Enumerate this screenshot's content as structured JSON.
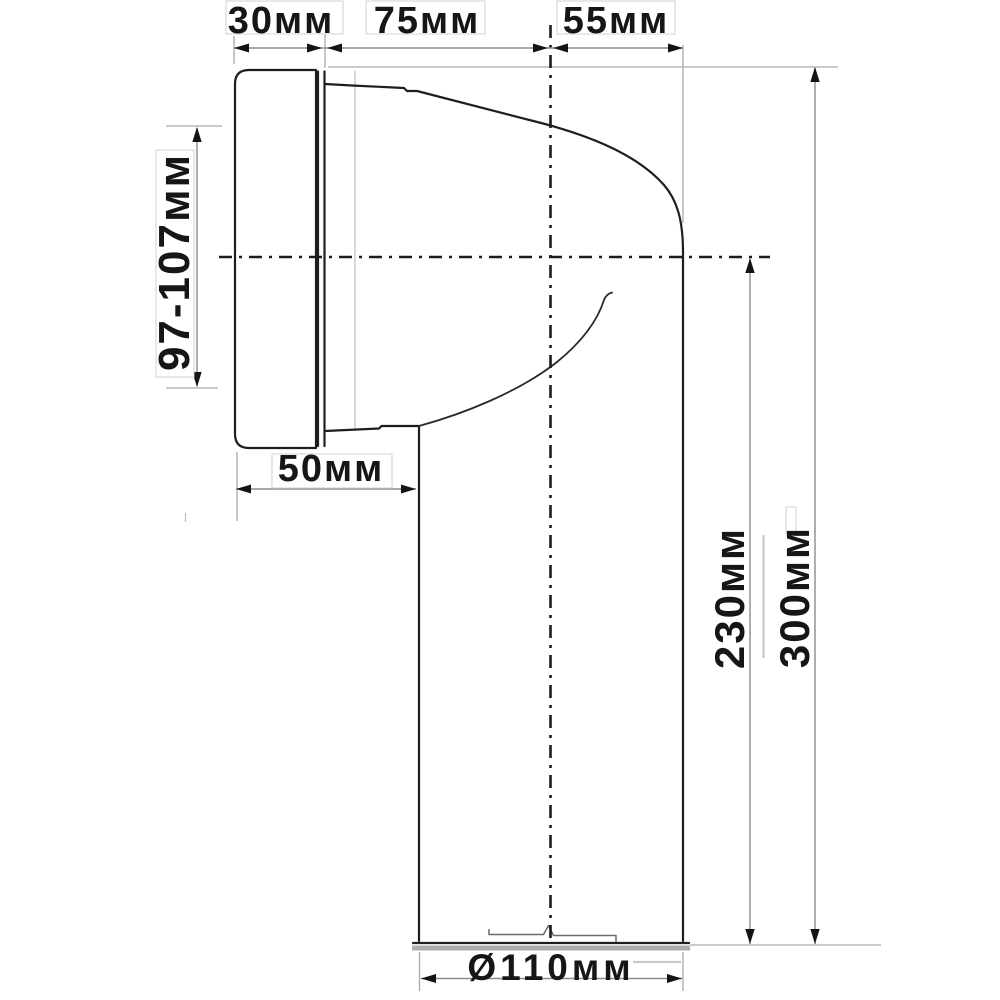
{
  "diagram": {
    "type": "technical-drawing",
    "subject": "wc-pan-connector-elbow-side-view",
    "labels": {
      "flange_depth": "30мм",
      "taper_length": "75мм",
      "bend_length": "55мм",
      "inlet_height_range": "97-107мм",
      "socket_length": "50мм",
      "axis_to_outlet_height": "230мм",
      "overall_height": "300мм",
      "outlet_diameter": "Ø110мм"
    },
    "colors": {
      "background": "#ffffff",
      "part_line": "#1e1e1e",
      "centerline": "#1c1c1c",
      "dimension_line": "#8c8c8c",
      "extension_line": "#ababab",
      "text": "#161616",
      "bottom_shadow": "#aeaeae"
    }
  }
}
